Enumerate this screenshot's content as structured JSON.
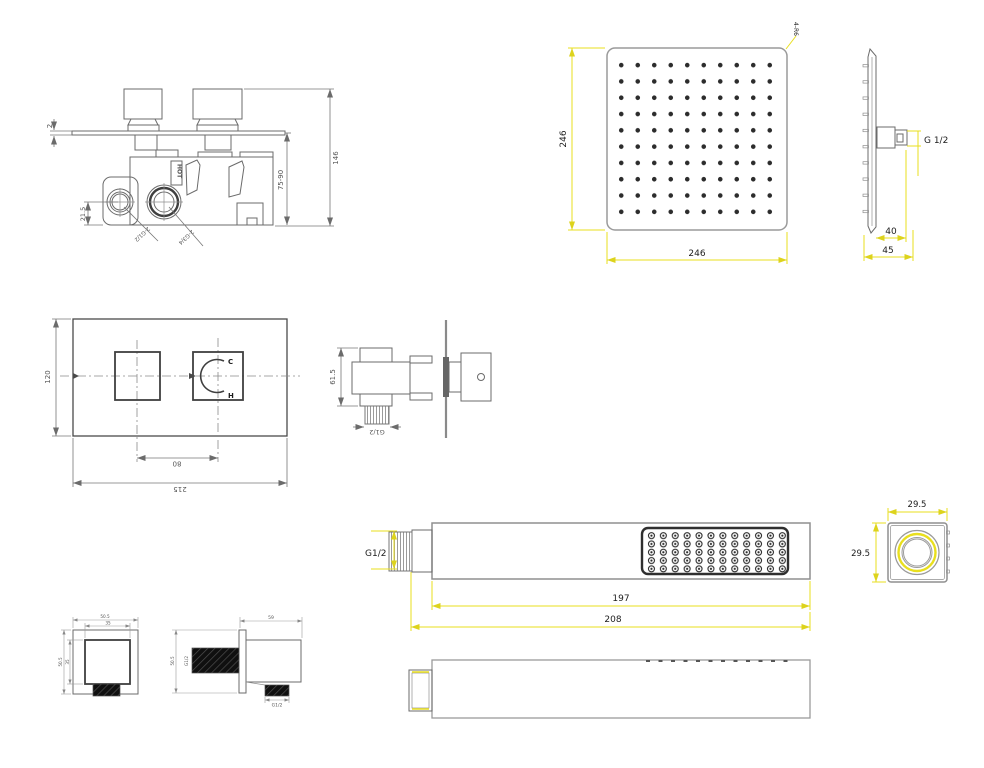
{
  "colors": {
    "dimension_yellow": "#e9df1e",
    "drawing_gray": "#6b6b6b",
    "dark_outline": "#3f3f3f",
    "text_black": "#1c1c1c",
    "text_gray": "#555555",
    "background": "#ffffff"
  },
  "views": {
    "mixer_valve_side": {
      "plate_thickness": "2",
      "overall_height": "146",
      "install_depth": "75-90",
      "port_offset": "21.5",
      "inlet_ports": "2-G1/2",
      "outlet_ports": "2-G3/4",
      "hot_marking": "HOT"
    },
    "shower_head_face": {
      "width": "246",
      "height": "246",
      "corner_radius": "4-R6"
    },
    "shower_head_side": {
      "thread": "G 1/2",
      "arm_depth": "40",
      "total_depth": "45"
    },
    "trim_plate_front": {
      "height": "120",
      "handle_spacing": "80",
      "width": "215",
      "cold_mark": "C",
      "hot_mark": "H"
    },
    "valve_cartridge_side": {
      "height": "61.5",
      "thread": "G1/2"
    },
    "hand_shower_top": {
      "thread": "G1/2",
      "body_length": "197",
      "total_length": "208"
    },
    "hand_shower_end": {
      "width": "29.5",
      "height": "29.5"
    },
    "wall_outlet_front": {
      "outer_width": "50.5",
      "inner_width": "35",
      "outer_height": "50.5",
      "inner_height": "35"
    },
    "wall_outlet_side": {
      "length": "59",
      "body_height": "50.5",
      "pipe_thread": "G1/2",
      "outlet_thread": "G1/2"
    }
  }
}
